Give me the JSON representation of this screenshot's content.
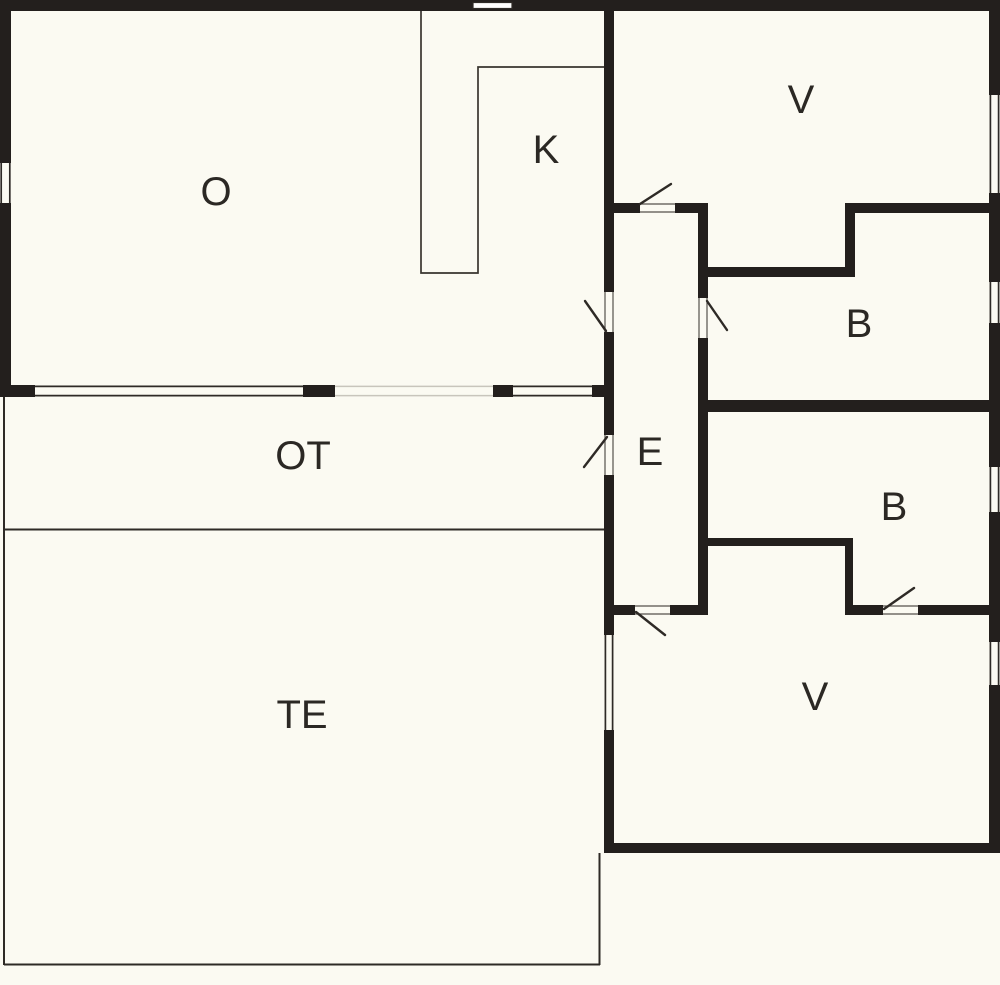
{
  "plan": {
    "type": "floor-plan",
    "colors": {
      "background": "#fbfaf2",
      "wall": "#231f1d",
      "line": "#2e2a26",
      "light_line": "#c8c5bc",
      "label": "#2b2824"
    },
    "rooms": {
      "o": {
        "label": "O"
      },
      "k": {
        "label": "K"
      },
      "v_north": {
        "label": "V"
      },
      "b_north": {
        "label": "B"
      },
      "e": {
        "label": "E"
      },
      "b_south": {
        "label": "B"
      },
      "v_south": {
        "label": "V"
      },
      "ot": {
        "label": "OT"
      },
      "te": {
        "label": "TE"
      }
    },
    "counts": {
      "door_swings": 6,
      "windows": 8
    }
  }
}
